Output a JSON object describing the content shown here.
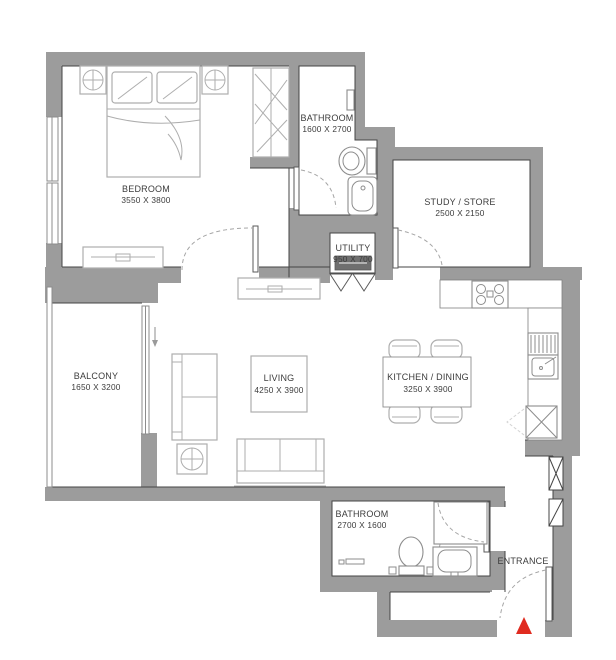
{
  "rooms": [
    {
      "id": "bedroom",
      "name": "BEDROOM",
      "dims": "3550 X 3800"
    },
    {
      "id": "bathroom_ensuite",
      "name": "BATHROOM",
      "dims": "1600 X 2700"
    },
    {
      "id": "study_store",
      "name": "STUDY / STORE",
      "dims": "2500 X 2150"
    },
    {
      "id": "utility",
      "name": "UTILITY",
      "dims": "950 X 700"
    },
    {
      "id": "balcony",
      "name": "BALCONY",
      "dims": "1650 X 3200"
    },
    {
      "id": "living",
      "name": "LIVING",
      "dims": "4250 X 3900"
    },
    {
      "id": "kitchen_dining",
      "name": "KITCHEN / DINING",
      "dims": "3250 X 3900"
    },
    {
      "id": "bathroom_main",
      "name": "BATHROOM",
      "dims": "2700 X 1600"
    },
    {
      "id": "entrance",
      "name": "ENTRANCE"
    }
  ],
  "symbols": {
    "entrance_marker": "red-triangle",
    "door_swing": "dashed-quarter-arc",
    "shaft_x": "box-with-x",
    "shaft_vent": "box-with-diagonal",
    "lamp": "circle-with-cross"
  },
  "colors": {
    "wall": "#9c9c9c",
    "edge": "#454545",
    "furniture": "#aeaeae",
    "fixture": "#8d8d8d",
    "arc": "#a6a6a6",
    "appliance": "#6f6f6f",
    "marker": "#e02b20",
    "text": "#3c3c3c",
    "bg": "#ffffff"
  }
}
